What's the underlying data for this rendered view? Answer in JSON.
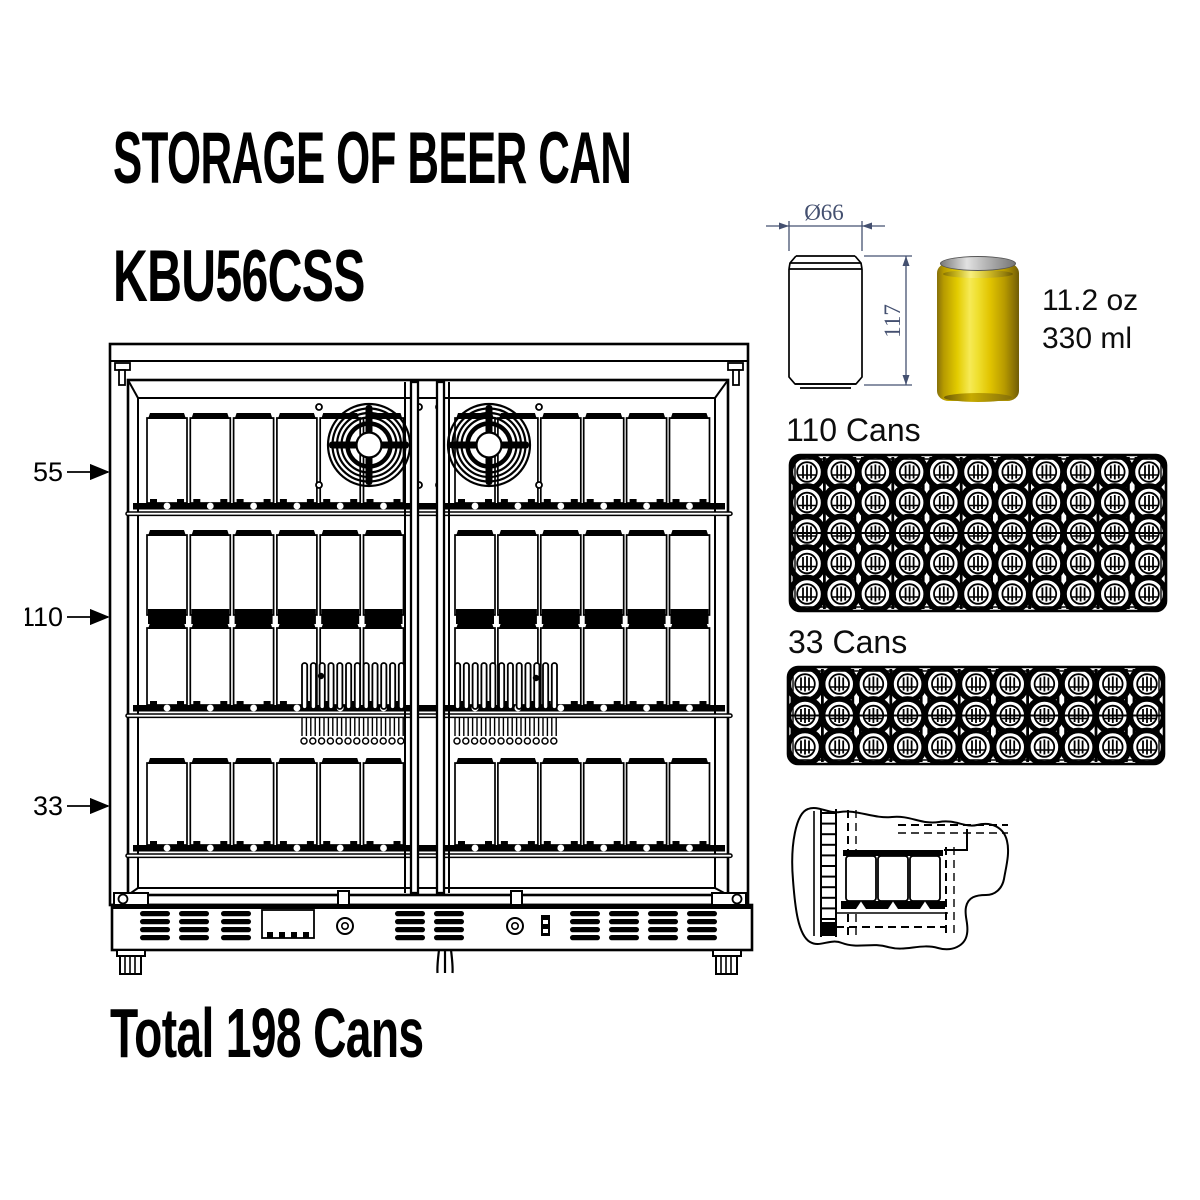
{
  "header": {
    "title": "STORAGE OF BEER CAN",
    "model": "KBU56CSS"
  },
  "fridge_diagram": {
    "shelf_labels": [
      {
        "label": "55"
      },
      {
        "label": "110"
      },
      {
        "label": "33"
      }
    ],
    "visible_cans_per_row": 12,
    "rows_of_cans": 4,
    "fan_count": 2
  },
  "can_spec": {
    "diameter_label": "Ø66",
    "height_label": "117",
    "size_oz": "11.2 oz",
    "size_ml": "330 ml"
  },
  "trays": [
    {
      "label": "110 Cans",
      "rows": 5,
      "cols": 11
    },
    {
      "label": "33 Cans",
      "rows": 3,
      "cols": 11
    }
  ],
  "total_label": "Total 198 Cans",
  "colors": {
    "line": "#000000",
    "dimension": "#445070",
    "can_yellow": "#e8cf00",
    "can_lid_silver": "#c9c9c9"
  }
}
